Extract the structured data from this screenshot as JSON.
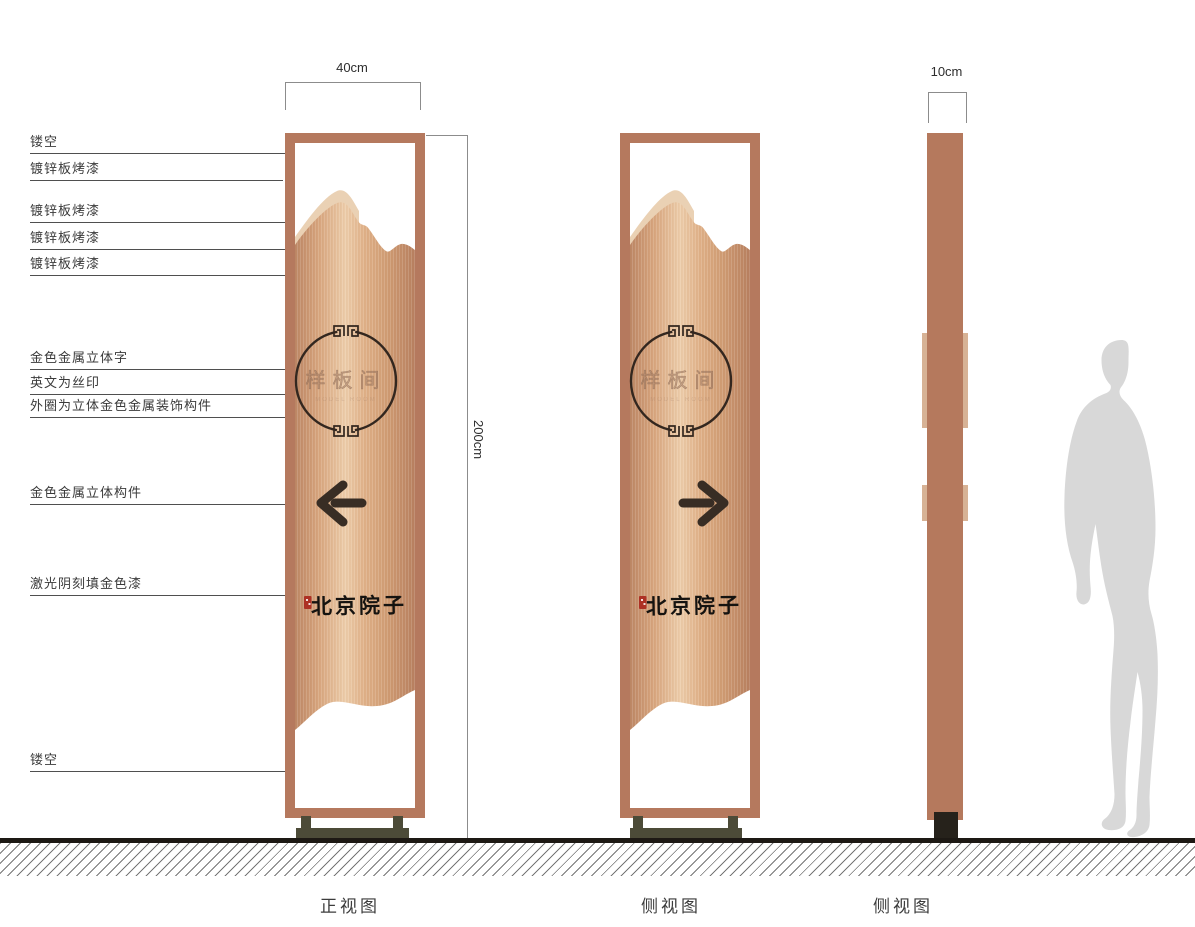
{
  "drawing": {
    "callouts": [
      "镂空",
      "镀锌板烤漆",
      "镀锌板烤漆",
      "镀锌板烤漆",
      "镀锌板烤漆",
      "金色金属立体字",
      "英文为丝印",
      "外圈为立体金色金属装饰构件",
      "金色金属立体构件",
      "激光阴刻填金色漆",
      "镂空"
    ],
    "dimensions": {
      "front_width": "40cm",
      "height": "200cm",
      "side_width": "10cm"
    },
    "views": [
      "正视图",
      "侧视图",
      "侧视图"
    ],
    "sign_content": {
      "circle_text": "样板间",
      "circle_subtext": "MODEL ROOM",
      "brand_text": "北京院子",
      "front_arrow": "left",
      "side_arrow": "right"
    },
    "colors": {
      "copper_frame": "#b5795e",
      "copper_light": "#edcdaa",
      "copper_dark": "#bd8765",
      "panel_back_ridge": "#ead1b4",
      "base_stand": "#4c4b38",
      "seal_red": "#ad3124",
      "ink": "#382d24",
      "silhouette": "#d8d8d8"
    }
  }
}
